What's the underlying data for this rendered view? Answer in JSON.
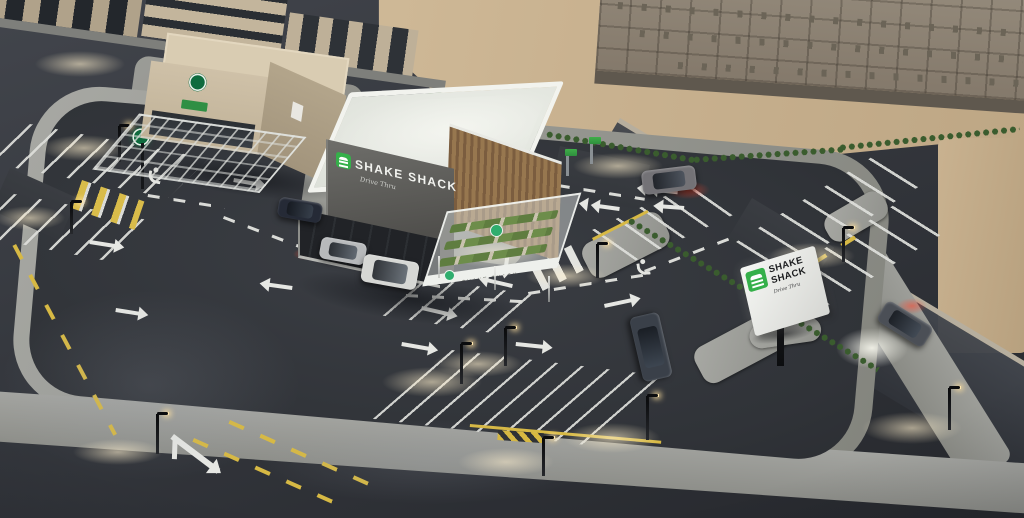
{
  "scene": {
    "description": "Dusk aerial 3D architectural rendering of a Shake Shack drive-thru restaurant site: main restaurant building with rooftop parapet, wood-slat facade and outdoor seating canopy, drive-thru lane with queued vehicles, parking lots with painted stalls, arrows and accessible markings, a neighboring cafe building with round green logo, a roadside pylon sign, surrounding roads with street lights and moving cars, and a large construction site on sand at the top right",
    "signs": {
      "wall": {
        "brand": "SHAKE SHACK",
        "subtitle": "Drive Thru",
        "logo": "green-burger-logo"
      },
      "canopy": {
        "brand": "SHAKE SHACK"
      },
      "pylon": {
        "line1": "SHAKE",
        "line2": "SHACK",
        "subtitle": "Drive Thru",
        "logo": "green-burger-logo"
      },
      "cafe": {
        "logo": "green-round-logo"
      }
    },
    "colors": {
      "brand_green": "#35b04a",
      "asphalt": "#34373d",
      "sidewalk": "#9c9d99",
      "sand": "#cdb795",
      "marking_white": "#e4e5e1",
      "marking_yellow": "#d7b944",
      "roof_white": "#eef0ea",
      "wood_slats": "#8a6b47",
      "light_glow": "#ffeecb",
      "taillight_red": "#ff4630"
    },
    "items": [
      {
        "t": "sandpatch",
        "n": "sand-shoulder",
        "x": 938,
        "y": 138,
        "w": 90,
        "h": 215
      },
      {
        "t": "side",
        "n": "east-sidewalk",
        "x": 844,
        "y": 186,
        "w": 320,
        "h": 54,
        "r": 58
      },
      {
        "t": "deckpost",
        "n": "construction-columns",
        "x": 618,
        "y": 2,
        "w": 400,
        "h": 7,
        "r": 4
      },
      {
        "t": "deckpost",
        "n": "construction-columns",
        "x": 640,
        "y": 30,
        "w": 384,
        "h": 7,
        "r": 4
      },
      {
        "t": "deckpost",
        "n": "construction-columns",
        "x": 678,
        "y": 62,
        "w": 346,
        "h": 7,
        "r": 3
      },
      {
        "t": "ent",
        "n": "west-entrance",
        "x": 10,
        "y": 168,
        "w": 74,
        "h": 46,
        "r": 24
      },
      {
        "t": "ent",
        "n": "north-entrance",
        "x": 560,
        "y": 146,
        "w": 92,
        "h": 46,
        "r": 12
      },
      {
        "t": "ent",
        "n": "east-entrance",
        "x": 752,
        "y": 198,
        "w": 96,
        "h": 50,
        "r": 31
      },
      {
        "t": "island",
        "n": "curb-island",
        "x": 578,
        "y": 248,
        "w": 88,
        "h": 38,
        "r": -27
      },
      {
        "t": "island",
        "n": "curb-island",
        "x": 690,
        "y": 352,
        "w": 92,
        "h": 40,
        "r": -28
      },
      {
        "t": "island",
        "n": "curb-island",
        "x": 820,
        "y": 220,
        "w": 66,
        "h": 30,
        "r": -30
      },
      {
        "t": "island",
        "n": "sign-base-island",
        "x": 748,
        "y": 326,
        "w": 72,
        "h": 24,
        "r": -8
      },
      {
        "t": "stalls",
        "n": "parking-stalls",
        "x": 30,
        "y": 124,
        "w": 182,
        "h": 46,
        "r": 11,
        "sx": -35
      },
      {
        "t": "stalls",
        "n": "parking-stalls",
        "x": 14,
        "y": 194,
        "w": 152,
        "h": 48,
        "r": 11,
        "sx": -35
      },
      {
        "t": "stalls",
        "n": "parking-stalls",
        "x": 426,
        "y": 278,
        "w": 112,
        "h": 44,
        "r": 9,
        "sx": -40
      },
      {
        "t": "stalls",
        "n": "parking-stalls",
        "x": 592,
        "y": 230,
        "w": 108,
        "h": 46,
        "r": -25,
        "sx": 30
      },
      {
        "t": "stalls",
        "n": "parking-stalls",
        "x": 452,
        "y": 350,
        "w": 232,
        "h": 78,
        "r": 7,
        "sx": -42
      },
      {
        "t": "stalls",
        "n": "parking-stalls",
        "x": 736,
        "y": 242,
        "w": 170,
        "h": 50,
        "r": -32,
        "sx": 26
      },
      {
        "t": "stalls",
        "n": "parking-stalls",
        "x": 758,
        "y": 290,
        "w": 170,
        "h": 50,
        "r": -32,
        "sx": 26
      },
      {
        "t": "dashy",
        "n": "road-centerline",
        "x": 16,
        "y": 244,
        "w": 215,
        "h": 4,
        "r": 62
      },
      {
        "t": "dashy",
        "n": "road-centerline",
        "x": 194,
        "y": 438,
        "w": 162,
        "h": 4,
        "r": 24
      },
      {
        "t": "dashy",
        "n": "road-centerline",
        "x": 230,
        "y": 420,
        "w": 152,
        "h": 4,
        "r": 24
      },
      {
        "t": "dashy",
        "n": "stall-centerline",
        "x": 754,
        "y": 298,
        "w": 132,
        "h": 4,
        "r": -32
      },
      {
        "t": "liney",
        "n": "curb-line",
        "x": 470,
        "y": 424,
        "w": 192,
        "h": 3,
        "r": 5
      },
      {
        "t": "liney",
        "n": "curb-line",
        "x": 592,
        "y": 238,
        "w": 62,
        "h": 3,
        "r": -27
      },
      {
        "t": "hatch",
        "n": "no-parking-hatch",
        "x": 498,
        "y": 430,
        "w": 46,
        "h": 10,
        "r": 4
      },
      {
        "t": "zebray",
        "n": "crosswalk",
        "x": 82,
        "y": 180,
        "w": 66,
        "h": 30,
        "r": 19
      },
      {
        "t": "zebra",
        "n": "crosswalk",
        "x": 200,
        "y": 94,
        "w": 58,
        "h": 22,
        "r": 11
      },
      {
        "t": "zebra",
        "n": "crosswalk",
        "x": 530,
        "y": 266,
        "w": 56,
        "h": 28,
        "r": -27
      },
      {
        "t": "dashw",
        "n": "lane-guide",
        "x": 148,
        "y": 194,
        "w": 78,
        "h": 3,
        "r": 9
      },
      {
        "t": "dashw",
        "n": "lane-guide",
        "x": 224,
        "y": 216,
        "w": 94,
        "h": 3,
        "r": 21
      },
      {
        "t": "dashw",
        "n": "lane-guide",
        "x": 304,
        "y": 250,
        "w": 106,
        "h": 3,
        "r": 11
      },
      {
        "t": "dashw",
        "n": "lane-guide",
        "x": 406,
        "y": 294,
        "w": 126,
        "h": 3,
        "r": 3
      },
      {
        "t": "dashw",
        "n": "lane-guide",
        "x": 528,
        "y": 292,
        "w": 122,
        "h": 3,
        "r": -9
      },
      {
        "t": "dashw",
        "n": "lane-guide",
        "x": 644,
        "y": 270,
        "w": 102,
        "h": 3,
        "r": -21
      },
      {
        "t": "dashw",
        "n": "lane-guide",
        "x": 558,
        "y": 184,
        "w": 88,
        "h": 3,
        "r": 9
      },
      {
        "t": "arrow",
        "n": "lane-arrow",
        "x": 90,
        "y": 240,
        "w": 32,
        "h": 4,
        "r": 9
      },
      {
        "t": "arrow",
        "n": "lane-arrow",
        "x": 234,
        "y": 178,
        "w": 30,
        "h": 4,
        "r": 10
      },
      {
        "t": "arrow",
        "n": "lane-arrow",
        "x": 116,
        "y": 308,
        "w": 30,
        "h": 4,
        "r": 9
      },
      {
        "t": "arrow",
        "n": "lane-arrow",
        "x": 422,
        "y": 306,
        "w": 34,
        "h": 4,
        "r": 13
      },
      {
        "t": "arrow",
        "n": "lane-arrow",
        "x": 402,
        "y": 342,
        "w": 34,
        "h": 4,
        "r": 10
      },
      {
        "t": "arrow",
        "n": "lane-arrow",
        "x": 512,
        "y": 288,
        "w": 32,
        "h": 4,
        "r": 193
      },
      {
        "t": "arrow",
        "n": "lane-arrow",
        "x": 516,
        "y": 342,
        "w": 34,
        "h": 4,
        "r": 6
      },
      {
        "t": "arrow",
        "n": "lane-arrow",
        "x": 604,
        "y": 304,
        "w": 34,
        "h": 4,
        "r": -12
      },
      {
        "t": "arrow",
        "n": "lane-arrow",
        "x": 510,
        "y": 252,
        "w": 24,
        "h": 4,
        "r": 98
      },
      {
        "t": "arrow",
        "n": "lane-arrow",
        "x": 292,
        "y": 290,
        "w": 30,
        "h": 4,
        "r": 188
      },
      {
        "t": "arrow",
        "n": "lane-arrow",
        "x": 684,
        "y": 210,
        "w": 28,
        "h": 4,
        "r": 184
      },
      {
        "t": "barrow",
        "n": "branch-arrow",
        "x": 174,
        "y": 434,
        "w": 58,
        "h": 6,
        "r": 37
      },
      {
        "t": "chev",
        "n": "yield-arrow",
        "x": 598,
        "y": 204,
        "w": 22,
        "h": 4,
        "r": 8
      },
      {
        "t": "chev",
        "n": "yield-arrow",
        "x": 656,
        "y": 188,
        "w": 22,
        "h": 4,
        "r": 6
      },
      {
        "t": "hc",
        "n": "accessible-marking",
        "x": 148,
        "y": 166,
        "w": 16,
        "h": 16,
        "r": 10
      },
      {
        "t": "hc",
        "n": "accessible-marking",
        "x": 634,
        "y": 260,
        "w": 16,
        "h": 16,
        "r": -6
      },
      {
        "t": "hedge",
        "n": "hedge",
        "x": 428,
        "y": 86,
        "w": 122,
        "h": 9,
        "r": 21
      },
      {
        "t": "hedge",
        "n": "hedge",
        "x": 546,
        "y": 130,
        "w": 152,
        "h": 9,
        "r": 10
      },
      {
        "t": "hedge",
        "n": "hedge",
        "x": 692,
        "y": 156,
        "w": 152,
        "h": 9,
        "r": -4
      },
      {
        "t": "hedge",
        "n": "hedge",
        "x": 838,
        "y": 144,
        "w": 182,
        "h": 9,
        "r": -6
      },
      {
        "t": "hedge",
        "n": "hedge",
        "x": 630,
        "y": 216,
        "w": 292,
        "h": 9,
        "r": 31
      },
      {
        "t": "gsign",
        "n": "wayfinding-sign",
        "x": 566,
        "y": 150,
        "w": 3,
        "h": 26
      },
      {
        "t": "gsign",
        "n": "wayfinding-sign",
        "x": 590,
        "y": 138,
        "w": 3,
        "h": 26
      },
      {
        "t": "gsign",
        "n": "wayfinding-sign",
        "x": 542,
        "y": 166,
        "w": 3,
        "h": 24
      },
      {
        "t": "rpole",
        "n": "cafe-pylon-sign",
        "x": 132,
        "y": 128,
        "w": 20,
        "h": 62
      },
      {
        "t": "pole",
        "n": "light-pole",
        "x": 118,
        "y": 126,
        "w": 3,
        "h": 36
      },
      {
        "t": "pole",
        "n": "light-pole",
        "x": 70,
        "y": 202,
        "w": 3,
        "h": 32
      },
      {
        "t": "pole",
        "n": "light-pole",
        "x": 460,
        "y": 344,
        "w": 3,
        "h": 40
      },
      {
        "t": "pole",
        "n": "light-pole",
        "x": 504,
        "y": 328,
        "w": 3,
        "h": 38
      },
      {
        "t": "pole",
        "n": "light-pole",
        "x": 646,
        "y": 396,
        "w": 3,
        "h": 44
      },
      {
        "t": "pole",
        "n": "light-pole",
        "x": 542,
        "y": 438,
        "w": 3,
        "h": 38
      },
      {
        "t": "pole",
        "n": "light-pole",
        "x": 596,
        "y": 244,
        "w": 3,
        "h": 34
      },
      {
        "t": "pole",
        "n": "light-pole",
        "x": 842,
        "y": 228,
        "w": 3,
        "h": 34
      },
      {
        "t": "pole",
        "n": "light-pole",
        "x": 156,
        "y": 414,
        "w": 3,
        "h": 40
      },
      {
        "t": "pole",
        "n": "light-pole",
        "x": 948,
        "y": 388,
        "w": 3,
        "h": 42
      },
      {
        "t": "pole",
        "n": "light-pole",
        "x": 254,
        "y": 116,
        "w": 3,
        "h": 30
      },
      {
        "t": "glow",
        "n": "light-glow",
        "x": 41,
        "y": 135,
        "w": 86,
        "h": 26
      },
      {
        "t": "glow",
        "n": "light-glow",
        "x": -5,
        "y": 206,
        "w": 70,
        "h": 24
      },
      {
        "t": "glow",
        "n": "light-glow",
        "x": 382,
        "y": 367,
        "w": 100,
        "h": 30
      },
      {
        "t": "glow",
        "n": "light-glow",
        "x": 433,
        "y": 351,
        "w": 90,
        "h": 26
      },
      {
        "t": "glow",
        "n": "light-glow",
        "x": 564,
        "y": 423,
        "w": 96,
        "h": 30
      },
      {
        "t": "glow",
        "n": "light-glow",
        "x": 458,
        "y": 448,
        "w": 96,
        "h": 28
      },
      {
        "t": "glow",
        "n": "light-glow",
        "x": 526,
        "y": 264,
        "w": 80,
        "h": 24
      },
      {
        "t": "glow",
        "n": "light-glow",
        "x": 769,
        "y": 243,
        "w": 86,
        "h": 26
      },
      {
        "t": "glow",
        "n": "light-glow",
        "x": 73,
        "y": 439,
        "w": 90,
        "h": 26
      },
      {
        "t": "glow",
        "n": "light-glow",
        "x": 862,
        "y": 412,
        "w": 100,
        "h": 32
      },
      {
        "t": "glow",
        "n": "light-glow",
        "x": 35,
        "y": 51,
        "w": 90,
        "h": 26
      },
      {
        "t": "glow",
        "n": "light-glow",
        "x": 204,
        "y": 91,
        "w": 96,
        "h": 26
      },
      {
        "t": "glow",
        "n": "light-glow",
        "x": 573,
        "y": 153,
        "w": 90,
        "h": 26
      },
      {
        "t": "glow",
        "n": "window-glow",
        "x": 448,
        "y": 238,
        "w": 96,
        "h": 30
      },
      {
        "t": "glow",
        "n": "window-glow",
        "x": 336,
        "y": 240,
        "w": 44,
        "h": 16
      },
      {
        "t": "haze",
        "n": "road-haze",
        "x": 0,
        "y": 290,
        "w": 300,
        "h": 190
      },
      {
        "t": "haze",
        "n": "road-haze",
        "x": 260,
        "y": 420,
        "w": 340,
        "h": 84
      },
      {
        "t": "glowr",
        "n": "taillight-glow",
        "x": 666,
        "y": 181,
        "w": 44,
        "h": 18
      },
      {
        "t": "glowr",
        "n": "taillight-glow",
        "x": 897,
        "y": 298,
        "w": 30,
        "h": 16
      },
      {
        "t": "glowr",
        "n": "brakelight-glow",
        "x": 293,
        "y": 248,
        "w": 26,
        "h": 12
      },
      {
        "t": "gloww",
        "n": "headlight-glow",
        "x": 836,
        "y": 328,
        "w": 72,
        "h": 40
      },
      {
        "t": "shadow",
        "n": "building-shadow",
        "x": 300,
        "y": 260,
        "w": 230,
        "h": 46,
        "r": 8
      },
      {
        "t": "shadow",
        "n": "building-shadow",
        "x": 148,
        "y": 146,
        "w": 200,
        "h": 36,
        "r": 8
      },
      {
        "t": "shadow",
        "n": "sign-shadow",
        "x": 750,
        "y": 332,
        "w": 66,
        "h": 16,
        "r": -10
      },
      {
        "t": "car",
        "n": "suv-dark",
        "x": 278,
        "y": 200,
        "w": 44,
        "h": 20,
        "r": 10,
        "c": "#252a36"
      },
      {
        "t": "car",
        "n": "sedan-silver",
        "x": 320,
        "y": 240,
        "w": 46,
        "h": 22,
        "r": 10,
        "c": "#b7b9bb"
      },
      {
        "t": "car",
        "n": "van-white",
        "x": 362,
        "y": 258,
        "w": 56,
        "h": 28,
        "r": 10,
        "c": "#d6d7d4"
      },
      {
        "t": "car",
        "n": "suv-gray-moving",
        "x": 642,
        "y": 168,
        "w": 54,
        "h": 24,
        "r": -7,
        "c": "#737276"
      },
      {
        "t": "car",
        "n": "sedan-parked",
        "x": 618,
        "y": 332,
        "w": 66,
        "h": 30,
        "r": 77,
        "c": "#3a4049"
      },
      {
        "t": "car",
        "n": "car-east-road",
        "x": 878,
        "y": 312,
        "w": 54,
        "h": 24,
        "r": 32,
        "c": "#4b4f56"
      }
    ]
  }
}
